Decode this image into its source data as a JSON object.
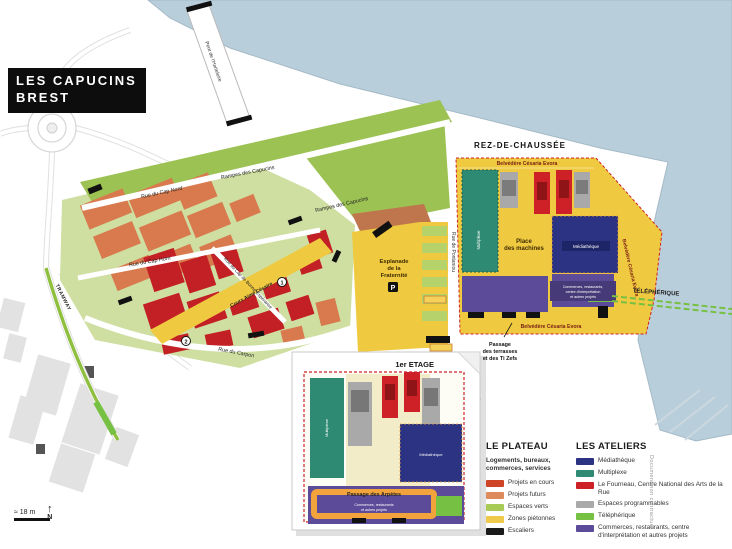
{
  "header": {
    "title_line1": "LES CAPUCINS",
    "title_line2": "BREST"
  },
  "map": {
    "floors": {
      "rdc": "REZ-DE-CHAUSSÉE",
      "etage": "1er ETAGE"
    },
    "belvedere": "Belvédère Césaria Evora",
    "place_des_machines": {
      "l1": "Place",
      "l2": "des machines"
    },
    "esplanade": {
      "l1": "Esplanade",
      "l2": "de la",
      "l3": "Fraternité"
    },
    "parking": "P",
    "telepherique": "TÉLÉPHÉRIQUE",
    "passage_terrasses": {
      "l1": "Passage",
      "l2": "des terrasses",
      "l3": "et des Ti Zefs"
    },
    "passage_arpetes": "Passage des Arpètes",
    "buildings": {
      "multiplexe": "Multiplexe",
      "mediatheque": "Médiathèque"
    },
    "commerces_label": {
      "l1": "Commerces, restaurants,",
      "l2": "centre d'interprétation",
      "l3": "et autres projets"
    },
    "inset_commerces": {
      "l1": "Commerces, restaurants",
      "l2": "et autres projets"
    },
    "streets": {
      "rampes_capucins": "Rampes des Capucins",
      "rue_cap_nord": "Rue du Cap Nord",
      "rue_cap_horn": "Rue du Cap Horn",
      "rue_bonne_esperance": "Rue du Cap de Bonne Espérance",
      "rue_carpon": "Rue du Carpon",
      "rue_pontaniou": "Rue de Pontaniou",
      "rue_maissin": "Rue Maissin",
      "cours_cesaire": "Cours Aimé Césaire",
      "tramway": "TRAMWAY",
      "pont_harteloire": "Pont de l'Harteloire"
    },
    "markers": {
      "num1": "1",
      "num2": "2"
    },
    "scale": "≈ 18 m",
    "north": "N",
    "credit": "Document non contractuel"
  },
  "legend": {
    "plateau": {
      "title": "LE PLATEAU",
      "subtitle": "Logements, bureaux, commerces, services",
      "items": [
        {
          "label": "Projets en cours",
          "color": "#cf4427"
        },
        {
          "label": "Projets futurs",
          "color": "#dd8b5c"
        },
        {
          "label": "Espaces verts",
          "color": "#a8cb55"
        },
        {
          "label": "Zones piétonnes",
          "color": "#efca4a"
        },
        {
          "label": "Escaliers",
          "color": "#1a1a1a"
        }
      ]
    },
    "ateliers": {
      "title": "LES ATELIERS",
      "items": [
        {
          "label": "Médiathèque",
          "color": "#2b3382"
        },
        {
          "label": "Multiplexe",
          "color": "#2f8a74"
        },
        {
          "label": "Le Fourneau, Centre National des Arts de la Rue",
          "color": "#cd2027"
        },
        {
          "label": "Espaces programmables",
          "color": "#a9a9a9"
        },
        {
          "label": "Téléphérique",
          "color": "#76c043"
        },
        {
          "label": "Commerces, restaurants, centre d'interprétation et autres projets",
          "color": "#5c4b99"
        }
      ]
    }
  }
}
